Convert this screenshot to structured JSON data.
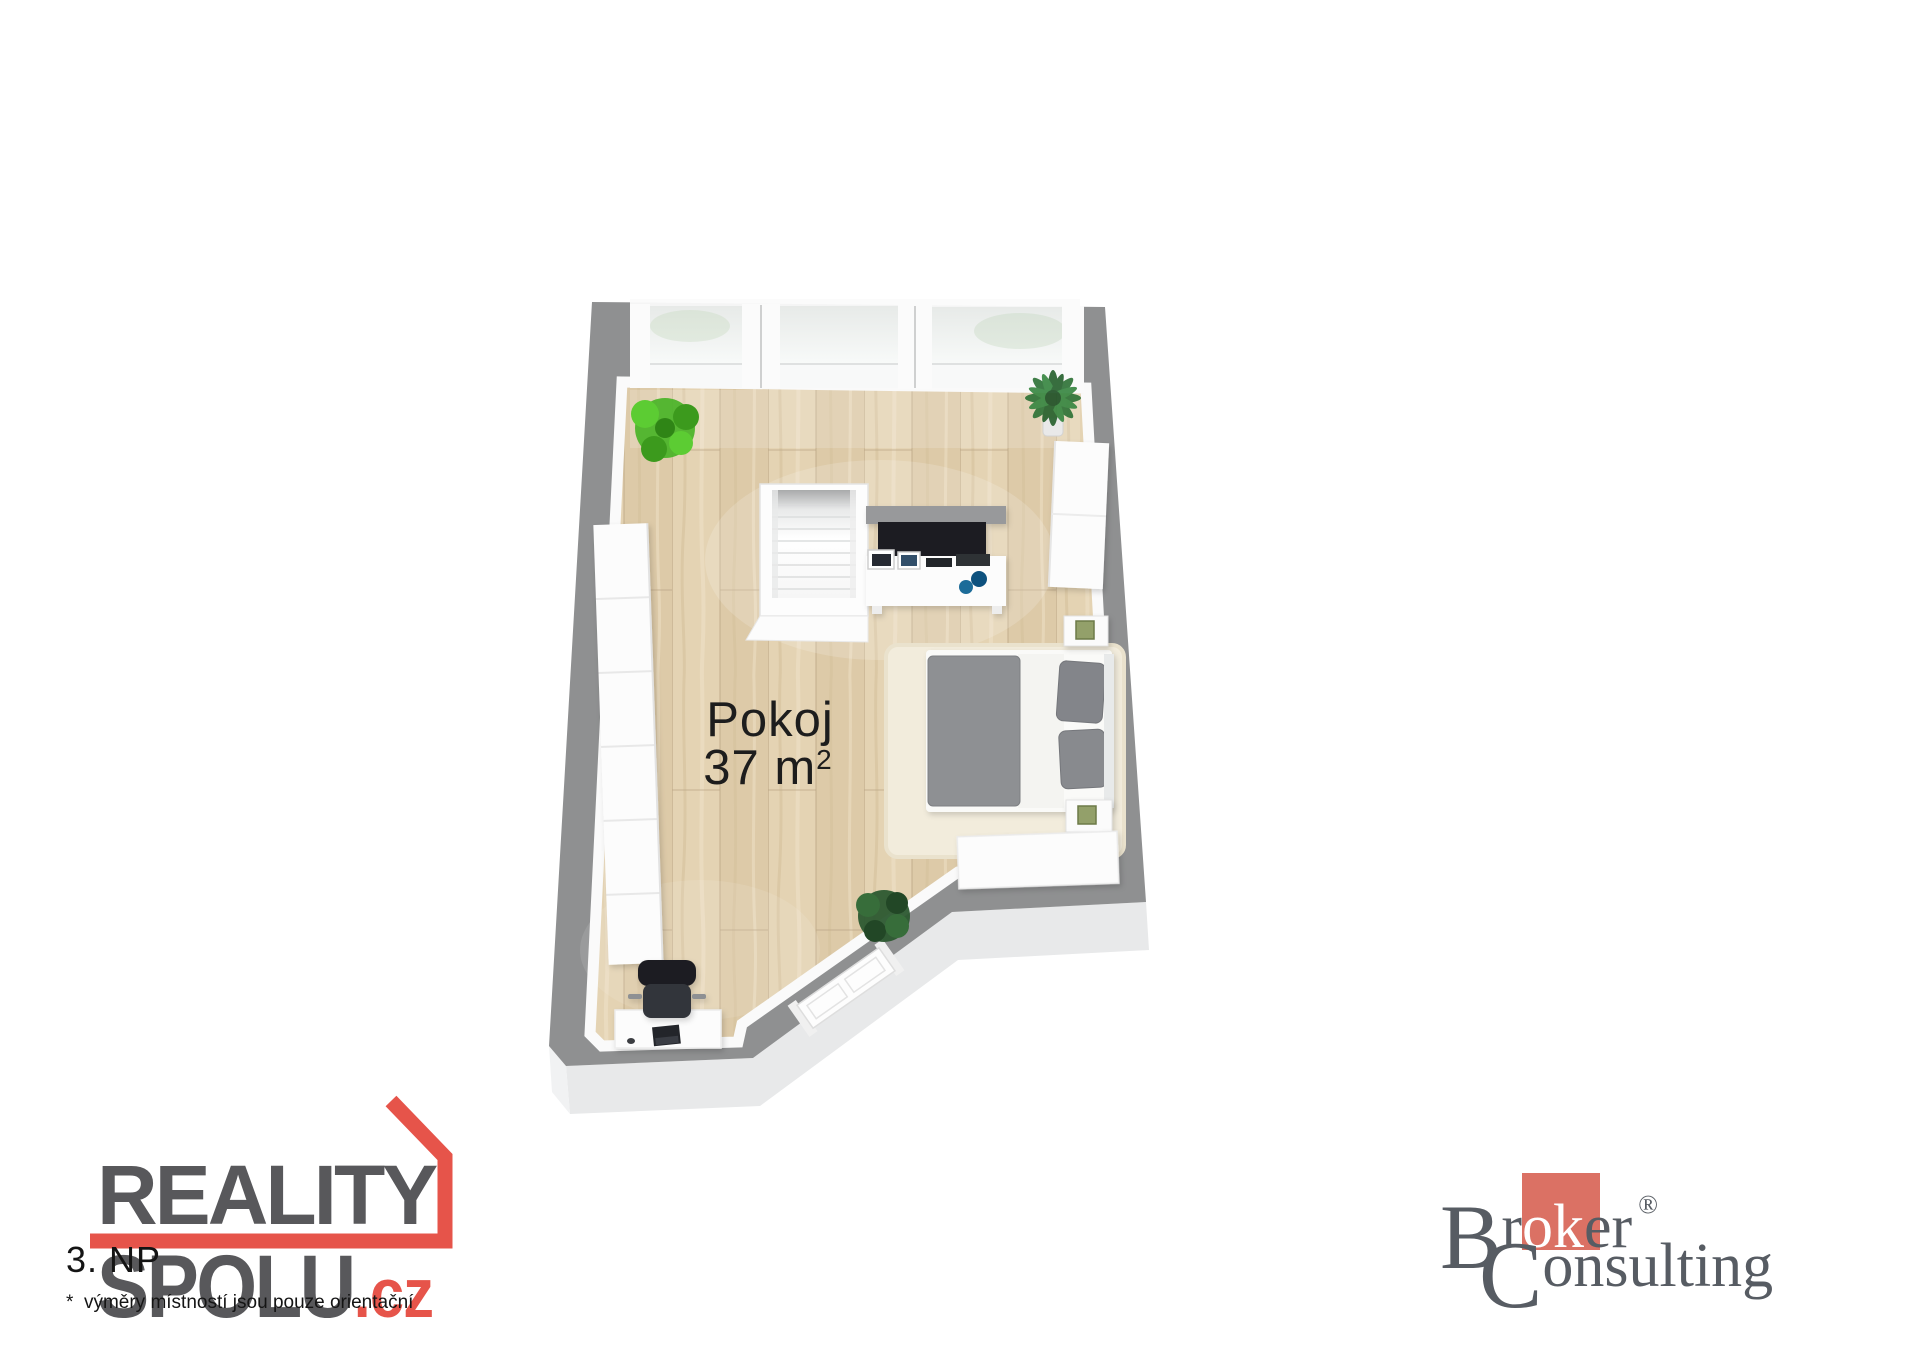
{
  "plan": {
    "room": {
      "name": "Pokoj",
      "area": "37 m",
      "area_sup": "2"
    }
  },
  "footer": {
    "floor_label": "3. NP",
    "disclaimer": "*  výměry místností jsou pouze orientační"
  },
  "reality_logo": {
    "line1": "REALITY",
    "line2": "SPOLU",
    "tld": ".cz",
    "gray_color": "#58585b",
    "red_color": "#e6544a"
  },
  "broker_logo": {
    "b": "B",
    "r": "r",
    "ok": "ok",
    "er": "er",
    "reg": "®",
    "c": "C",
    "onsulting": "onsulting",
    "text_color": "#575c63",
    "square_color": "#db7164"
  },
  "palette": {
    "wall_gray": "#8f9091",
    "floor_wood": "#e4d3b3",
    "bed_duvet_gray": "#8e9093",
    "plant_green": "#49b327"
  }
}
